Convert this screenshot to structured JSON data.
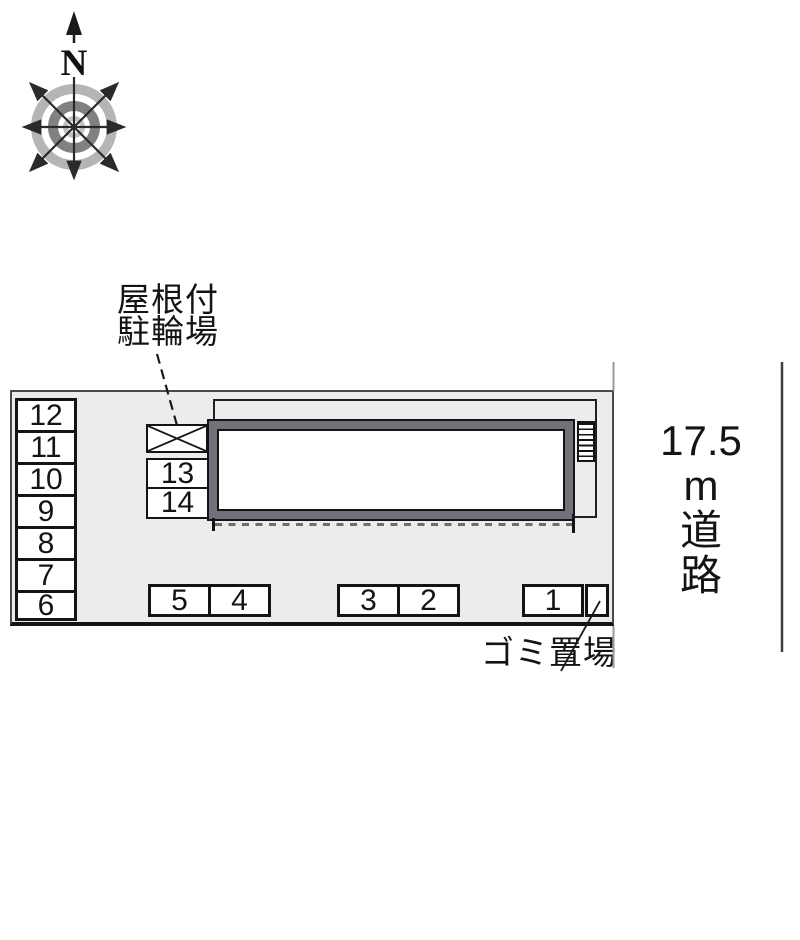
{
  "compass": {
    "north_label": "N"
  },
  "labels": {
    "bike_shed_line1": "屋根付",
    "bike_shed_line2": "駐輪場",
    "garbage": "ゴミ置場",
    "road_line1": "17.5",
    "road_line2": "m",
    "road_line3": "道",
    "road_line4": "路"
  },
  "parking": {
    "left_column": [
      "12",
      "11",
      "10",
      "9",
      "8",
      "7",
      "6"
    ],
    "center_column": [
      "13",
      "14"
    ],
    "bottom_group_a": [
      "5",
      "4"
    ],
    "bottom_group_b": [
      "3",
      "2"
    ],
    "bottom_group_c": [
      "1"
    ]
  },
  "colors": {
    "plan_background": "#ececec",
    "building_wall_gray": "#71717a",
    "outline_black": "#141414",
    "plan_border_gray": "#4a4a4a",
    "drip_line_gray": "#6e6e6e",
    "road_far_line": "#3f3f3f",
    "road_near_line": "#9a9a9a",
    "compass_ring_light": "#b5b5b5",
    "compass_ring_dark": "#818181",
    "compass_ring_center": "#c2c2c2"
  }
}
